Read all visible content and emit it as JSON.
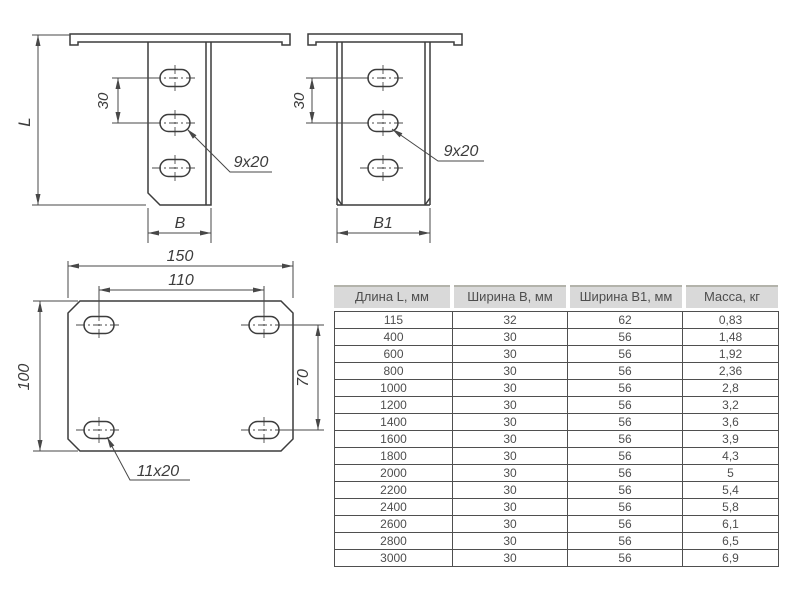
{
  "drawings": {
    "side_view": {
      "dim_length": "L",
      "dim_hole_pitch": "30",
      "dim_width": "B",
      "hole_label": "9x20"
    },
    "front_view": {
      "dim_hole_pitch": "30",
      "dim_width": "B1",
      "hole_label": "9x20"
    },
    "plan_view": {
      "dim_overall_width": "150",
      "dim_hole_span": "110",
      "dim_overall_height": "100",
      "dim_hole_span_v": "70",
      "hole_label": "11x20"
    }
  },
  "table": {
    "headers": [
      "Длина L, мм",
      "Ширина B, мм",
      "Ширина B1, мм",
      "Масса, кг"
    ],
    "rows": [
      [
        "115",
        "32",
        "62",
        "0,83"
      ],
      [
        "400",
        "30",
        "56",
        "1,48"
      ],
      [
        "600",
        "30",
        "56",
        "1,92"
      ],
      [
        "800",
        "30",
        "56",
        "2,36"
      ],
      [
        "1000",
        "30",
        "56",
        "2,8"
      ],
      [
        "1200",
        "30",
        "56",
        "3,2"
      ],
      [
        "1400",
        "30",
        "56",
        "3,6"
      ],
      [
        "1600",
        "30",
        "56",
        "3,9"
      ],
      [
        "1800",
        "30",
        "56",
        "4,3"
      ],
      [
        "2000",
        "30",
        "56",
        "5"
      ],
      [
        "2200",
        "30",
        "56",
        "5,4"
      ],
      [
        "2400",
        "30",
        "56",
        "5,8"
      ],
      [
        "2600",
        "30",
        "56",
        "6,1"
      ],
      [
        "2800",
        "30",
        "56",
        "6,5"
      ],
      [
        "3000",
        "30",
        "56",
        "6,9"
      ]
    ]
  },
  "colors": {
    "line": "#3c3c3c",
    "table_border": "#4f4f4f",
    "header_bg": "#d9d9d9",
    "header_top_border": "#b3b3ab",
    "text": "#4e4e4e"
  }
}
